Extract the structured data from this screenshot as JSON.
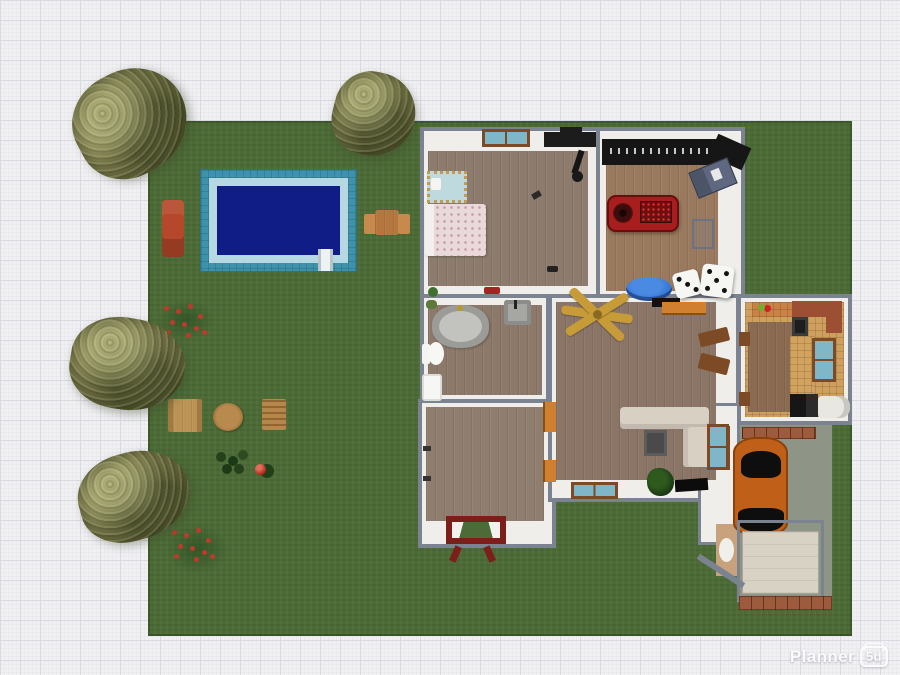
{
  "watermark": {
    "brand": "Planner",
    "badge": "5d"
  },
  "palette": {
    "bg": "#f1f1f4",
    "gridmin": "#e9e9ee",
    "gridmaj": "#d9d9e1",
    "lawn": "#4c6b36",
    "wall": "#7b8391",
    "wallface": "#efeeea",
    "woodbed": "#8d7c6e",
    "woodgame": "#9a7a5e",
    "woodbath": "#8c796a",
    "woodhall": "#8f7e6f",
    "woodliving": "#8a7567",
    "ktile": "#cf9f5e",
    "ptile": "#3e93ab",
    "prim": "#b5d8e3",
    "pwater": "#101d86",
    "sofa": "#d8d0c3",
    "redtable": "#a81d1d",
    "bar": "#161616",
    "pouf": "#2e6fd2",
    "car": "#c06018",
    "drive": "#8e9587",
    "gdoor": "#d8d2c4",
    "porch": "#7c1f1a",
    "tree": "#7c7b4c",
    "flower": "#c03a2c",
    "brick": "#9e5a3c",
    "counter": "#c98146",
    "counterdark": "#9c4f33",
    "doorbrown": "#7c4a24",
    "glass": "#7fb7c9",
    "bedpink": "#e9d9da",
    "gold": "#c79b38"
  },
  "scene": {
    "type": "floor-plan-top-view",
    "rooms": [
      "bedroom",
      "game-room",
      "bathroom",
      "hallway",
      "living-room",
      "kitchen",
      "garage",
      "utility"
    ],
    "garden": [
      "swimming-pool",
      "pool-ladder",
      "lounge-chair",
      "patio-table-set",
      "picnic-table",
      "round-table",
      "garden-bench",
      "tree",
      "rose-bush",
      "shrubs",
      "red-ball"
    ]
  }
}
